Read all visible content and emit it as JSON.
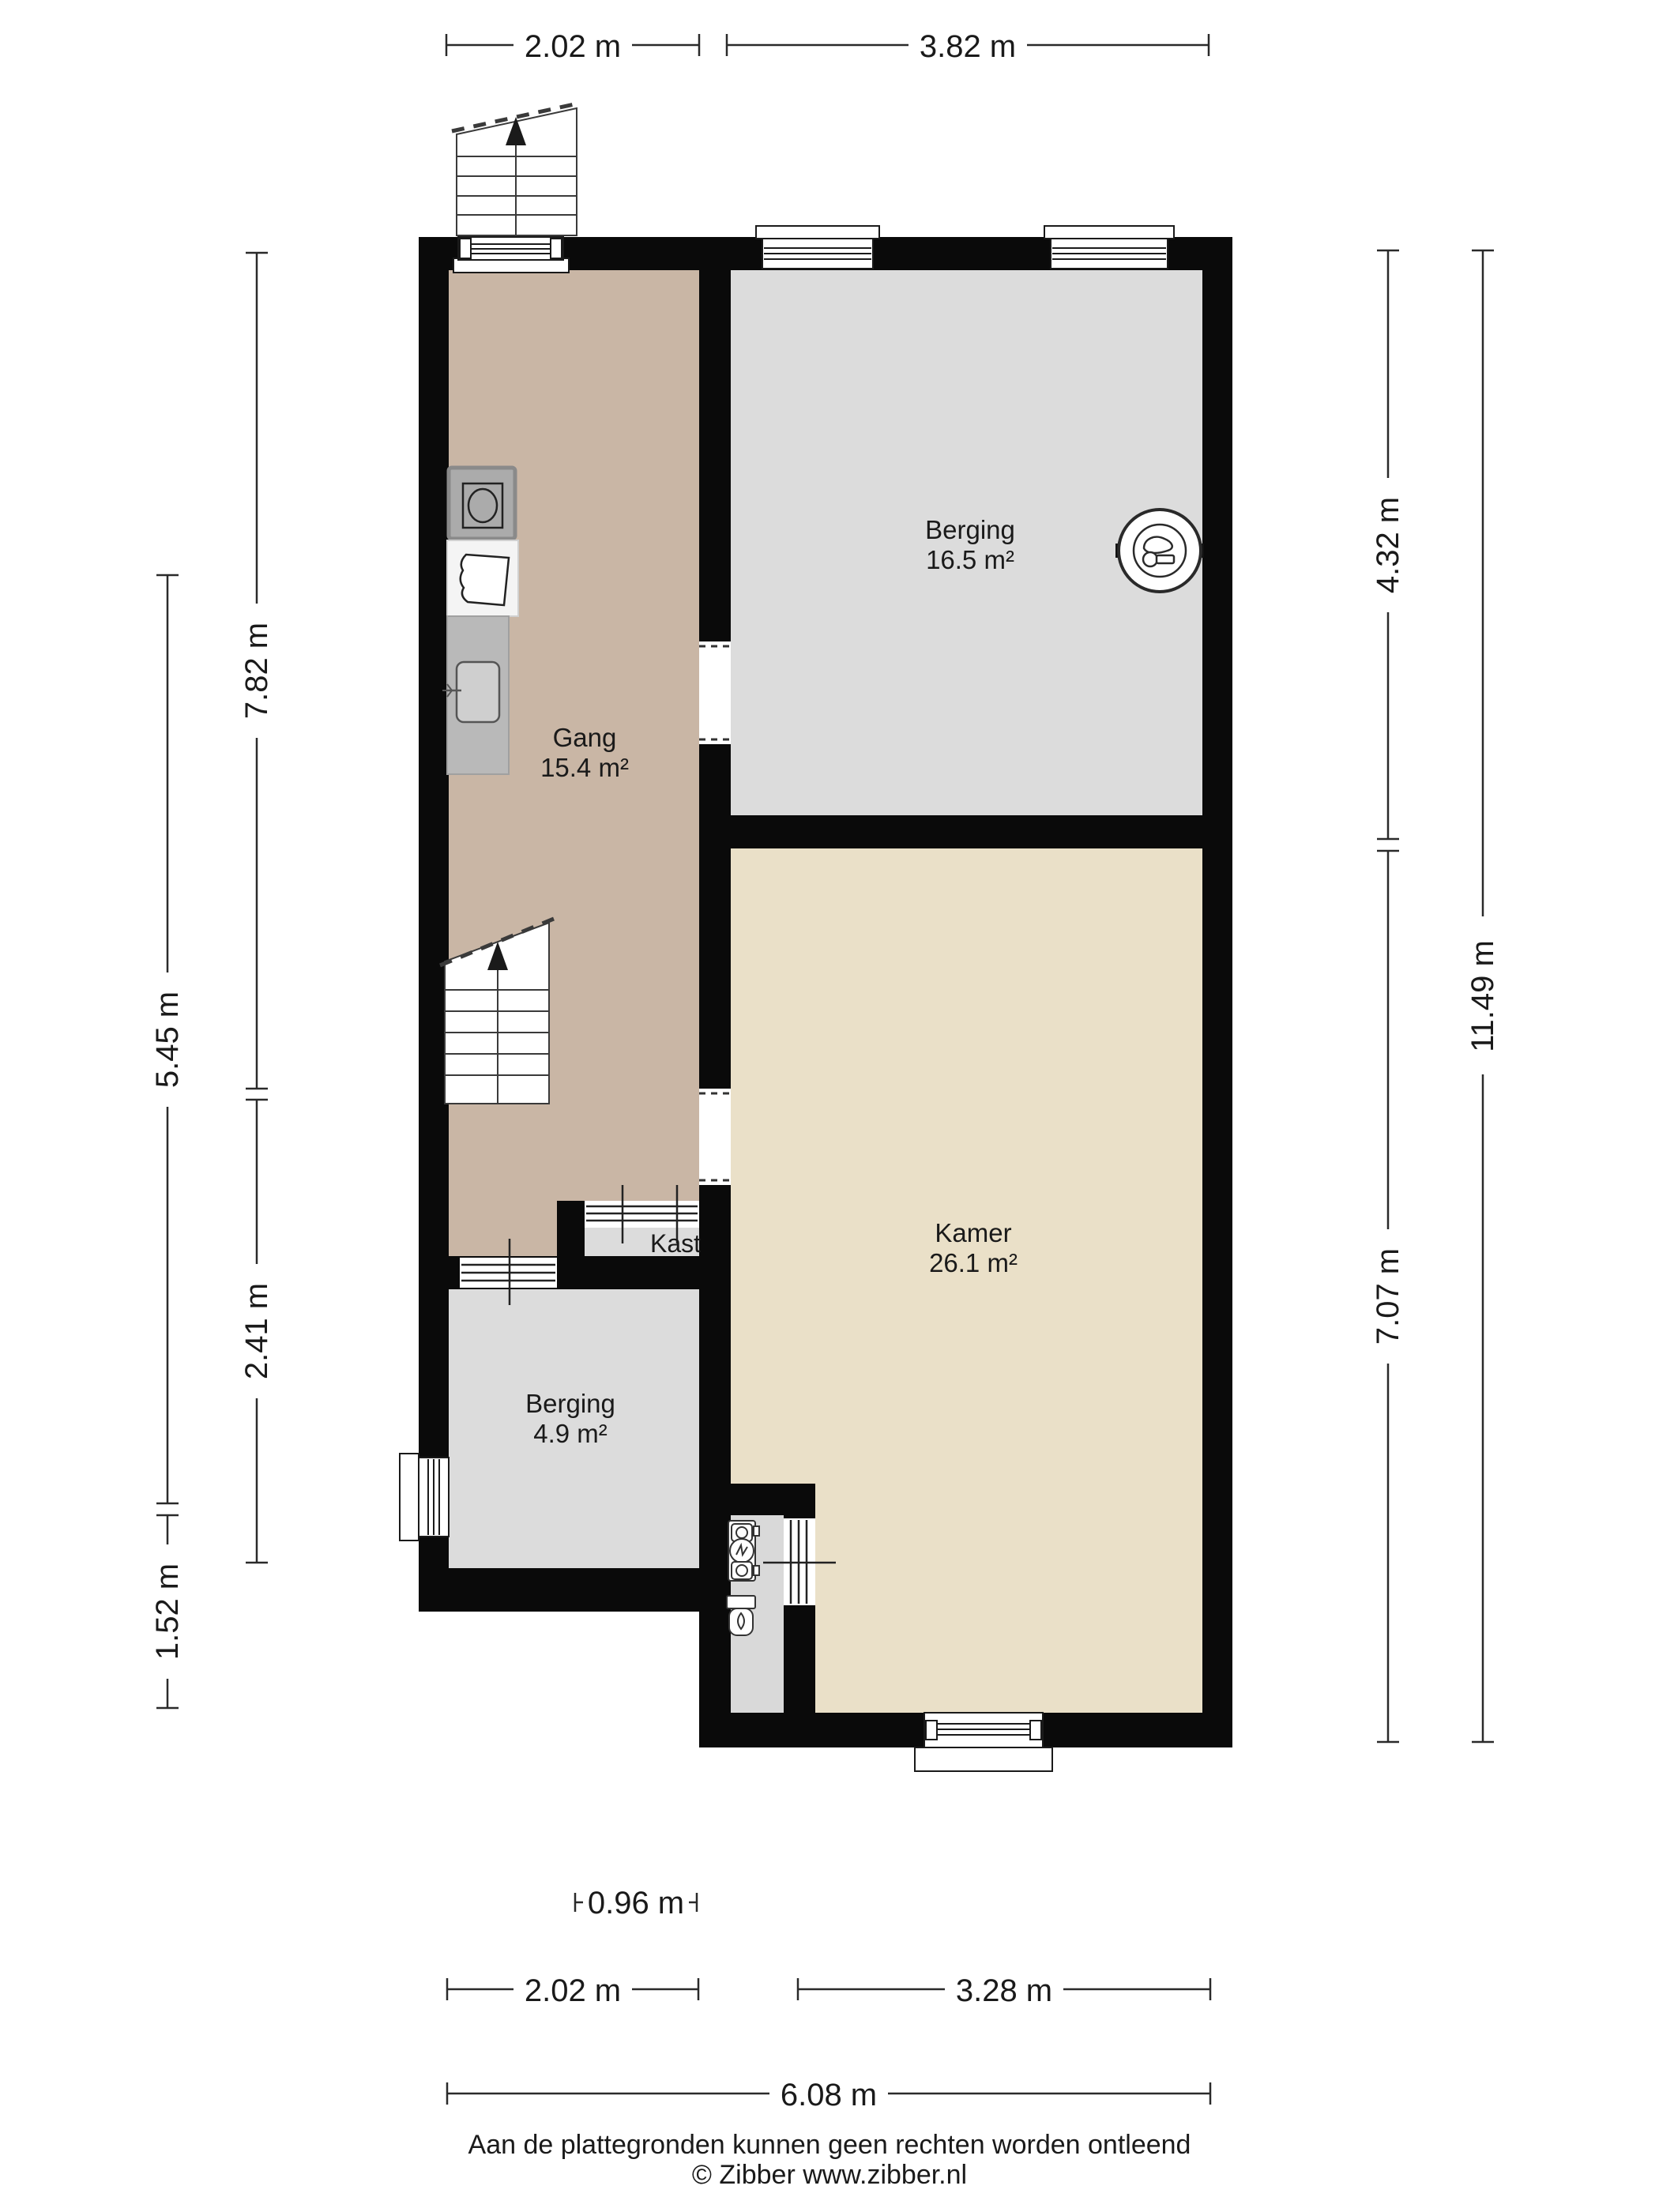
{
  "rooms": {
    "berging_top": {
      "name": "Berging",
      "area": "16.5 m²"
    },
    "gang": {
      "name": "Gang",
      "area": "15.4 m²"
    },
    "kamer": {
      "name": "Kamer",
      "area": "26.1 m²"
    },
    "berging_bottom": {
      "name": "Berging",
      "area": "4.9 m²"
    },
    "kast": {
      "name": "Kast"
    }
  },
  "dimensions": {
    "top_gang": "2.02 m",
    "top_berging": "3.82 m",
    "left_upper": "7.82 m",
    "left_mid": "5.45 m",
    "left_berging": "2.41 m",
    "left_lower": "1.52 m",
    "right_berging": "4.32 m",
    "right_kamer": "7.07 m",
    "right_total": "11.49 m",
    "bottom_kast": "0.96 m",
    "bottom_gang": "2.02 m",
    "bottom_kamer": "3.28 m",
    "bottom_total": "6.08 m"
  },
  "footer": {
    "disclaimer": "Aan de plattegronden kunnen geen rechten worden ontleend",
    "copyright": "© Zibber www.zibber.nl"
  },
  "colors": {
    "wall": "#0a0a0a",
    "gang": "#c9b6a5",
    "berging": "#dcdcdc",
    "kamer": "#eae0c8",
    "bathroom": "#d9d9d9",
    "kast": "#dcdcdc",
    "counter": "#b9b9b9",
    "machine": "#ababab",
    "white": "#ffffff",
    "line": "#2a2a2a"
  }
}
